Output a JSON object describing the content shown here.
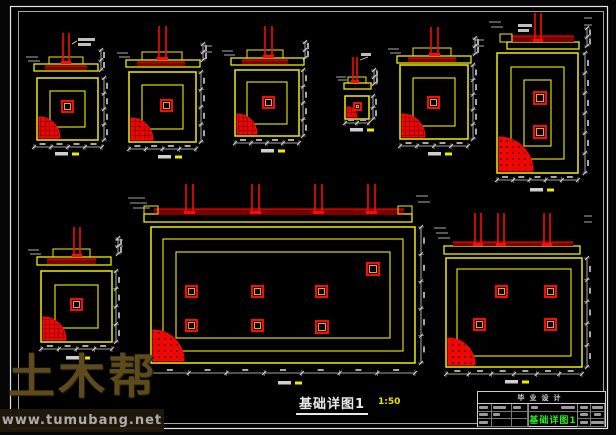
{
  "colors": {
    "yellow": "#f0ec00",
    "red": "#fb0b06",
    "dark_red": "#7c0000",
    "orange": "#ff9d00",
    "white": "#d8d8d8",
    "blob": "#a8a8a8",
    "border": "#e6e6e6",
    "green": "#27f01d"
  },
  "watermark": {
    "brand": "土木帮",
    "url": "www.tumubang.net"
  },
  "sheet_caption": {
    "title": "基础详图1",
    "scale": "1:50"
  },
  "title_block": {
    "project": "毕业设计",
    "drawing_name": "基础详图1"
  },
  "drawing": {
    "details": [
      {
        "name": "foundation-detail-1",
        "section": {
          "base": [
            34,
            64,
            64,
            7
          ],
          "slab": [
            45,
            66,
            42,
            4
          ],
          "steps": [
            [
              49,
              57,
              34,
              7
            ]
          ],
          "columns": [
            [
              63,
              69,
              33,
              64
            ]
          ],
          "marks": [
            [
              26,
              57,
              38,
              57
            ],
            [
              28,
              61,
              40,
              61
            ],
            [
              72,
              44,
              77,
              41
            ]
          ]
        },
        "plan": {
          "rect": [
            37,
            78,
            61,
            62
          ],
          "rings": [
            13
          ],
          "squares": [
            [
              62,
              101,
              11
            ]
          ],
          "quarter": {
            "r": 21,
            "style": "hatch"
          }
        },
        "dims": [
          {
            "o": "h",
            "x": 34,
            "y": 147,
            "len": 68,
            "n": 4
          },
          {
            "o": "v",
            "x": 104,
            "y": 78,
            "len": 62,
            "n": 4
          },
          {
            "o": "v",
            "x": 101,
            "y": 50,
            "len": 20,
            "n": 2
          }
        ],
        "caption": [
          55,
          152
        ],
        "blobs": [
          [
            78,
            38,
            17,
            3
          ],
          [
            78,
            43,
            13,
            3
          ]
        ]
      },
      {
        "name": "foundation-detail-2",
        "section": {
          "base": [
            126,
            60,
            74,
            7
          ],
          "slab": [
            137,
            62,
            48,
            4
          ],
          "steps": [
            [
              142,
              52,
              40,
              8
            ]
          ],
          "columns": [
            [
              159,
              166,
              26,
              60
            ]
          ],
          "marks": [
            [
              117,
              53,
              128,
              53
            ],
            [
              119,
              57,
              130,
              57
            ],
            [
              204,
              46,
              212,
              46
            ],
            [
              204,
              52,
              212,
              52
            ]
          ]
        },
        "plan": {
          "rect": [
            129,
            72,
            67,
            70
          ],
          "rings": [
            13
          ],
          "squares": [
            [
              161,
              100,
              11
            ]
          ],
          "quarter": {
            "r": 22,
            "style": "hatch"
          }
        },
        "dims": [
          {
            "o": "h",
            "x": 129,
            "y": 149,
            "len": 67,
            "n": 4
          },
          {
            "o": "v",
            "x": 201,
            "y": 72,
            "len": 70,
            "n": 4
          },
          {
            "o": "v",
            "x": 203,
            "y": 44,
            "len": 16,
            "n": 2
          }
        ],
        "caption": [
          158,
          155
        ],
        "blobs": []
      },
      {
        "name": "foundation-detail-3",
        "section": {
          "base": [
            231,
            58,
            73,
            7
          ],
          "slab": [
            242,
            60,
            46,
            4
          ],
          "steps": [
            [
              247,
              50,
              36,
              8
            ]
          ],
          "columns": [
            [
              265,
              272,
              26,
              58
            ]
          ],
          "marks": [
            [
              222,
              51,
              233,
              51
            ],
            [
              224,
              55,
              235,
              55
            ]
          ]
        },
        "plan": {
          "rect": [
            235,
            70,
            64,
            66
          ],
          "rings": [
            12
          ],
          "squares": [
            [
              263,
              97,
              11
            ]
          ],
          "quarter": {
            "r": 20,
            "style": "hatch"
          }
        },
        "dims": [
          {
            "o": "h",
            "x": 235,
            "y": 143,
            "len": 64,
            "n": 4
          },
          {
            "o": "v",
            "x": 303,
            "y": 70,
            "len": 66,
            "n": 4
          },
          {
            "o": "v",
            "x": 305,
            "y": 42,
            "len": 16,
            "n": 2
          }
        ],
        "caption": [
          261,
          149
        ],
        "blobs": []
      },
      {
        "name": "foundation-detail-4-small",
        "section": {
          "base": [
            344,
            83,
            27,
            6
          ],
          "slab": null,
          "steps": [
            [
              348,
              77,
              18,
              6
            ]
          ],
          "columns": [
            [
              353,
              357,
              57,
              83
            ]
          ],
          "marks": [
            [
              336,
              77,
              346,
              77
            ],
            [
              338,
              80,
              347,
              80
            ],
            [
              360,
              60,
              368,
              57
            ]
          ]
        },
        "plan": {
          "rect": [
            345,
            96,
            24,
            23
          ],
          "rings": [],
          "squares": [
            [
              354,
              103,
              7
            ]
          ],
          "quarter": {
            "r": 10,
            "style": "hatch"
          }
        },
        "dims": [
          {
            "o": "h",
            "x": 345,
            "y": 123,
            "len": 24,
            "n": 2
          },
          {
            "o": "v",
            "x": 373,
            "y": 96,
            "len": 23,
            "n": 2
          },
          {
            "o": "v",
            "x": 374,
            "y": 70,
            "len": 14,
            "n": 2
          }
        ],
        "caption": [
          350,
          128
        ],
        "blobs": [
          [
            361,
            53,
            10,
            3
          ]
        ]
      },
      {
        "name": "foundation-detail-5",
        "section": {
          "base": [
            397,
            56,
            74,
            7
          ],
          "slab": [
            408,
            58,
            48,
            4
          ],
          "steps": [
            [
              413,
              48,
              38,
              8
            ]
          ],
          "columns": [
            [
              431,
              438,
              27,
              56
            ]
          ],
          "marks": [
            [
              388,
              49,
              399,
              49
            ],
            [
              390,
              53,
              401,
              53
            ],
            [
              475,
              40,
              484,
              40
            ],
            [
              475,
              46,
              484,
              46
            ]
          ]
        },
        "plan": {
          "rect": [
            400,
            65,
            68,
            74
          ],
          "rings": [
            13
          ],
          "squares": [
            [
              428,
              97,
              11
            ]
          ],
          "quarter": {
            "r": 23,
            "style": "hatch"
          }
        },
        "dims": [
          {
            "o": "h",
            "x": 400,
            "y": 146,
            "len": 68,
            "n": 4
          },
          {
            "o": "v",
            "x": 473,
            "y": 65,
            "len": 74,
            "n": 5
          },
          {
            "o": "v",
            "x": 475,
            "y": 38,
            "len": 16,
            "n": 2
          }
        ],
        "caption": [
          428,
          152
        ],
        "blobs": []
      },
      {
        "name": "foundation-detail-6-tall",
        "section": {
          "base": [
            507,
            42,
            72,
            7
          ],
          "slab": [
            511,
            36,
            63,
            6
          ],
          "steps": [
            [
              500,
              34,
              12,
              8
            ]
          ],
          "columns": [
            [
              535,
              541,
              13,
              42
            ]
          ],
          "marks": [
            [
              489,
              22,
              501,
              22
            ],
            [
              491,
              27,
              503,
              27
            ],
            [
              584,
              18,
              592,
              18
            ],
            [
              584,
              25,
              592,
              25
            ]
          ]
        },
        "plan": {
          "rect": [
            497,
            53,
            81,
            120
          ],
          "rings": [
            14,
            27
          ],
          "squares": [
            [
              534,
              92,
              12
            ],
            [
              534,
              126,
              12
            ]
          ],
          "quarter": {
            "r": 34,
            "style": "dots"
          }
        },
        "dims": [
          {
            "o": "h",
            "x": 497,
            "y": 180,
            "len": 81,
            "n": 5
          },
          {
            "o": "v",
            "x": 585,
            "y": 53,
            "len": 120,
            "n": 6
          },
          {
            "o": "v",
            "x": 587,
            "y": 28,
            "len": 18,
            "n": 2
          }
        ],
        "caption": [
          530,
          188
        ],
        "blobs": [
          [
            518,
            24,
            14,
            3
          ],
          [
            518,
            29,
            11,
            3
          ]
        ]
      },
      {
        "name": "foundation-detail-7-large",
        "section": {
          "base": [
            144,
            214,
            268,
            8
          ],
          "slab": [
            154,
            209,
            250,
            6
          ],
          "steps": [
            [
              144,
              206,
              14,
              8
            ],
            [
              398,
              206,
              14,
              8
            ]
          ],
          "columns": [
            [
              186,
              193,
              184,
              214
            ],
            [
              252,
              259,
              184,
              214
            ],
            [
              315,
              322,
              184,
              214
            ],
            [
              368,
              375,
              184,
              214
            ]
          ],
          "marks": [
            [
              128,
              198,
              145,
              198
            ],
            [
              130,
              203,
              147,
              203
            ],
            [
              133,
              208,
              150,
              208
            ],
            [
              416,
              196,
              428,
              196
            ],
            [
              418,
              202,
              430,
              202
            ]
          ]
        },
        "plan": {
          "rect": [
            151,
            227,
            264,
            136
          ],
          "rings": [
            12,
            25
          ],
          "squares": [
            [
              186,
              286,
              11
            ],
            [
              252,
              286,
              11
            ],
            [
              316,
              286,
              11
            ],
            [
              186,
              320,
              11
            ],
            [
              252,
              320,
              11
            ],
            [
              316,
              321,
              12
            ],
            [
              367,
              263,
              12
            ]
          ],
          "quarter": {
            "r": 31,
            "style": "dots"
          }
        },
        "dims": [
          {
            "o": "h",
            "x": 151,
            "y": 373,
            "len": 264,
            "n": 7
          },
          {
            "o": "v",
            "x": 421,
            "y": 227,
            "len": 136,
            "n": 5
          }
        ],
        "caption": [
          278,
          381
        ],
        "blobs": []
      },
      {
        "name": "foundation-detail-8",
        "section": {
          "base": [
            37,
            257,
            74,
            8
          ],
          "slab": [
            47,
            259,
            49,
            5
          ],
          "steps": [
            [
              53,
              249,
              37,
              8
            ]
          ],
          "columns": [
            [
              74,
              80,
              227,
              257
            ]
          ],
          "marks": [
            [
              28,
              250,
              39,
              250
            ],
            [
              30,
              254,
              41,
              254
            ],
            [
              115,
              240,
              123,
              240
            ],
            [
              115,
              246,
              123,
              246
            ]
          ]
        },
        "plan": {
          "rect": [
            41,
            271,
            71,
            71
          ],
          "rings": [
            14
          ],
          "squares": [
            [
              71,
              299,
              11
            ]
          ],
          "quarter": {
            "r": 23,
            "style": "hatch"
          }
        },
        "dims": [
          {
            "o": "h",
            "x": 41,
            "y": 349,
            "len": 71,
            "n": 4
          },
          {
            "o": "v",
            "x": 116,
            "y": 271,
            "len": 71,
            "n": 4
          },
          {
            "o": "v",
            "x": 118,
            "y": 238,
            "len": 16,
            "n": 2
          }
        ],
        "caption": [
          66,
          356
        ],
        "blobs": []
      },
      {
        "name": "foundation-detail-9",
        "section": {
          "base": [
            444,
            246,
            136,
            8
          ],
          "slab": [
            453,
            242,
            120,
            4
          ],
          "steps": [],
          "columns": [
            [
              475,
              481,
              213,
              246
            ],
            [
              498,
              504,
              213,
              246
            ],
            [
              544,
              550,
              213,
              246
            ]
          ],
          "marks": [
            [
              434,
              228,
              446,
              228
            ],
            [
              436,
              233,
              448,
              233
            ],
            [
              438,
              238,
              450,
              238
            ],
            [
              584,
              216,
              592,
              216
            ],
            [
              584,
              222,
              592,
              222
            ]
          ]
        },
        "plan": {
          "rect": [
            446,
            258,
            136,
            109
          ],
          "rings": [
            11
          ],
          "squares": [
            [
              496,
              286,
              11
            ],
            [
              545,
              286,
              11
            ],
            [
              474,
              319,
              11
            ],
            [
              545,
              319,
              11
            ]
          ],
          "quarter": {
            "r": 27,
            "style": "dots"
          }
        },
        "dims": [
          {
            "o": "h",
            "x": 446,
            "y": 374,
            "len": 136,
            "n": 6
          },
          {
            "o": "v",
            "x": 587,
            "y": 258,
            "len": 109,
            "n": 5
          }
        ],
        "caption": [
          505,
          380
        ],
        "blobs": []
      }
    ]
  }
}
